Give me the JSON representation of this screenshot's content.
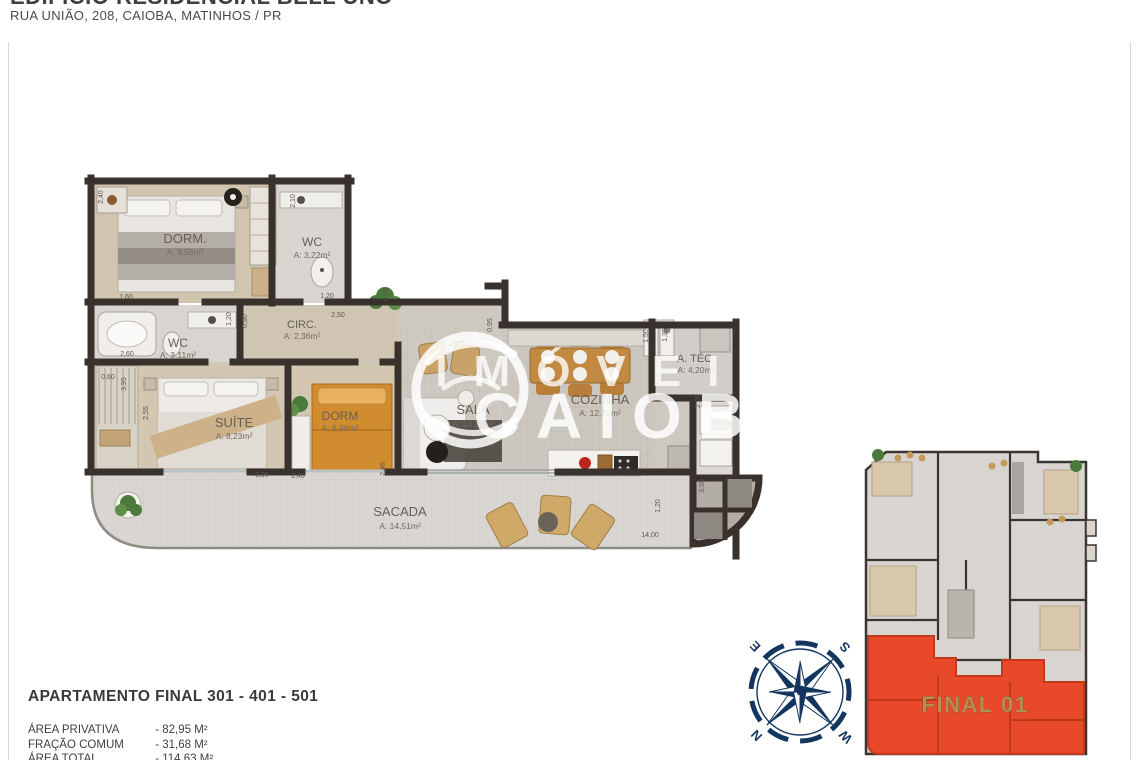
{
  "header": {
    "title": "EDIFÍCIO RESIDENCIAL BELL UNO",
    "address": "RUA UNIÃO, 208, CAIOBA, MATINHOS / PR"
  },
  "plan": {
    "rooms": [
      {
        "name": "DORM.",
        "area": "A: 9,56m²"
      },
      {
        "name": "WC",
        "area": "A: 3,22m²"
      },
      {
        "name": "WC",
        "area": "A: 3,11m²"
      },
      {
        "name": "CIRC.",
        "area": "A: 2,36m²"
      },
      {
        "name": "SUÍTE",
        "area": "A: 8,23m²"
      },
      {
        "name": "DORM",
        "area": "A: 6,96m²"
      },
      {
        "name": "SALA",
        "area": "A: 13,85m²"
      },
      {
        "name": "COZINHA",
        "area": "A: 12,73m²"
      },
      {
        "name": "A. TÉC.",
        "area": "A: 4,20m²"
      },
      {
        "name": "SACADA",
        "area": "A: 14,51m²"
      }
    ],
    "dims": [
      "2,40",
      "1,60",
      "2,10",
      "1,20",
      "0,60",
      "2,50",
      "1,20",
      "0,90",
      "2,60",
      "0,60",
      "3,95",
      "2,55",
      "3,06",
      "2,40",
      "2,46",
      "0,95",
      "1,50",
      "1,35",
      "2,05",
      "3,55",
      "1,20",
      "14,00"
    ]
  },
  "watermark": {
    "line1": "IMÓVEIS",
    "line2": "CAIOBÁ"
  },
  "overview": {
    "label": "FINAL 01"
  },
  "compass": {
    "n": "N",
    "s": "S",
    "e": "E",
    "w": "W"
  },
  "footer": {
    "title": "APARTAMENTO FINAL 301 - 401 - 501",
    "rows": [
      {
        "label": "ÁREA PRIVATIVA",
        "value": "- 82,95 M²"
      },
      {
        "label": "FRAÇÃO COMUM",
        "value": "- 31,68 M²"
      },
      {
        "label": "ÁREA TOTAL",
        "value": "- 114,63 M²"
      }
    ]
  },
  "colors": {
    "wall": "#39322c",
    "highlight": "#e8492b",
    "compass": "#13365f",
    "highlight_label": "#b98c54"
  }
}
